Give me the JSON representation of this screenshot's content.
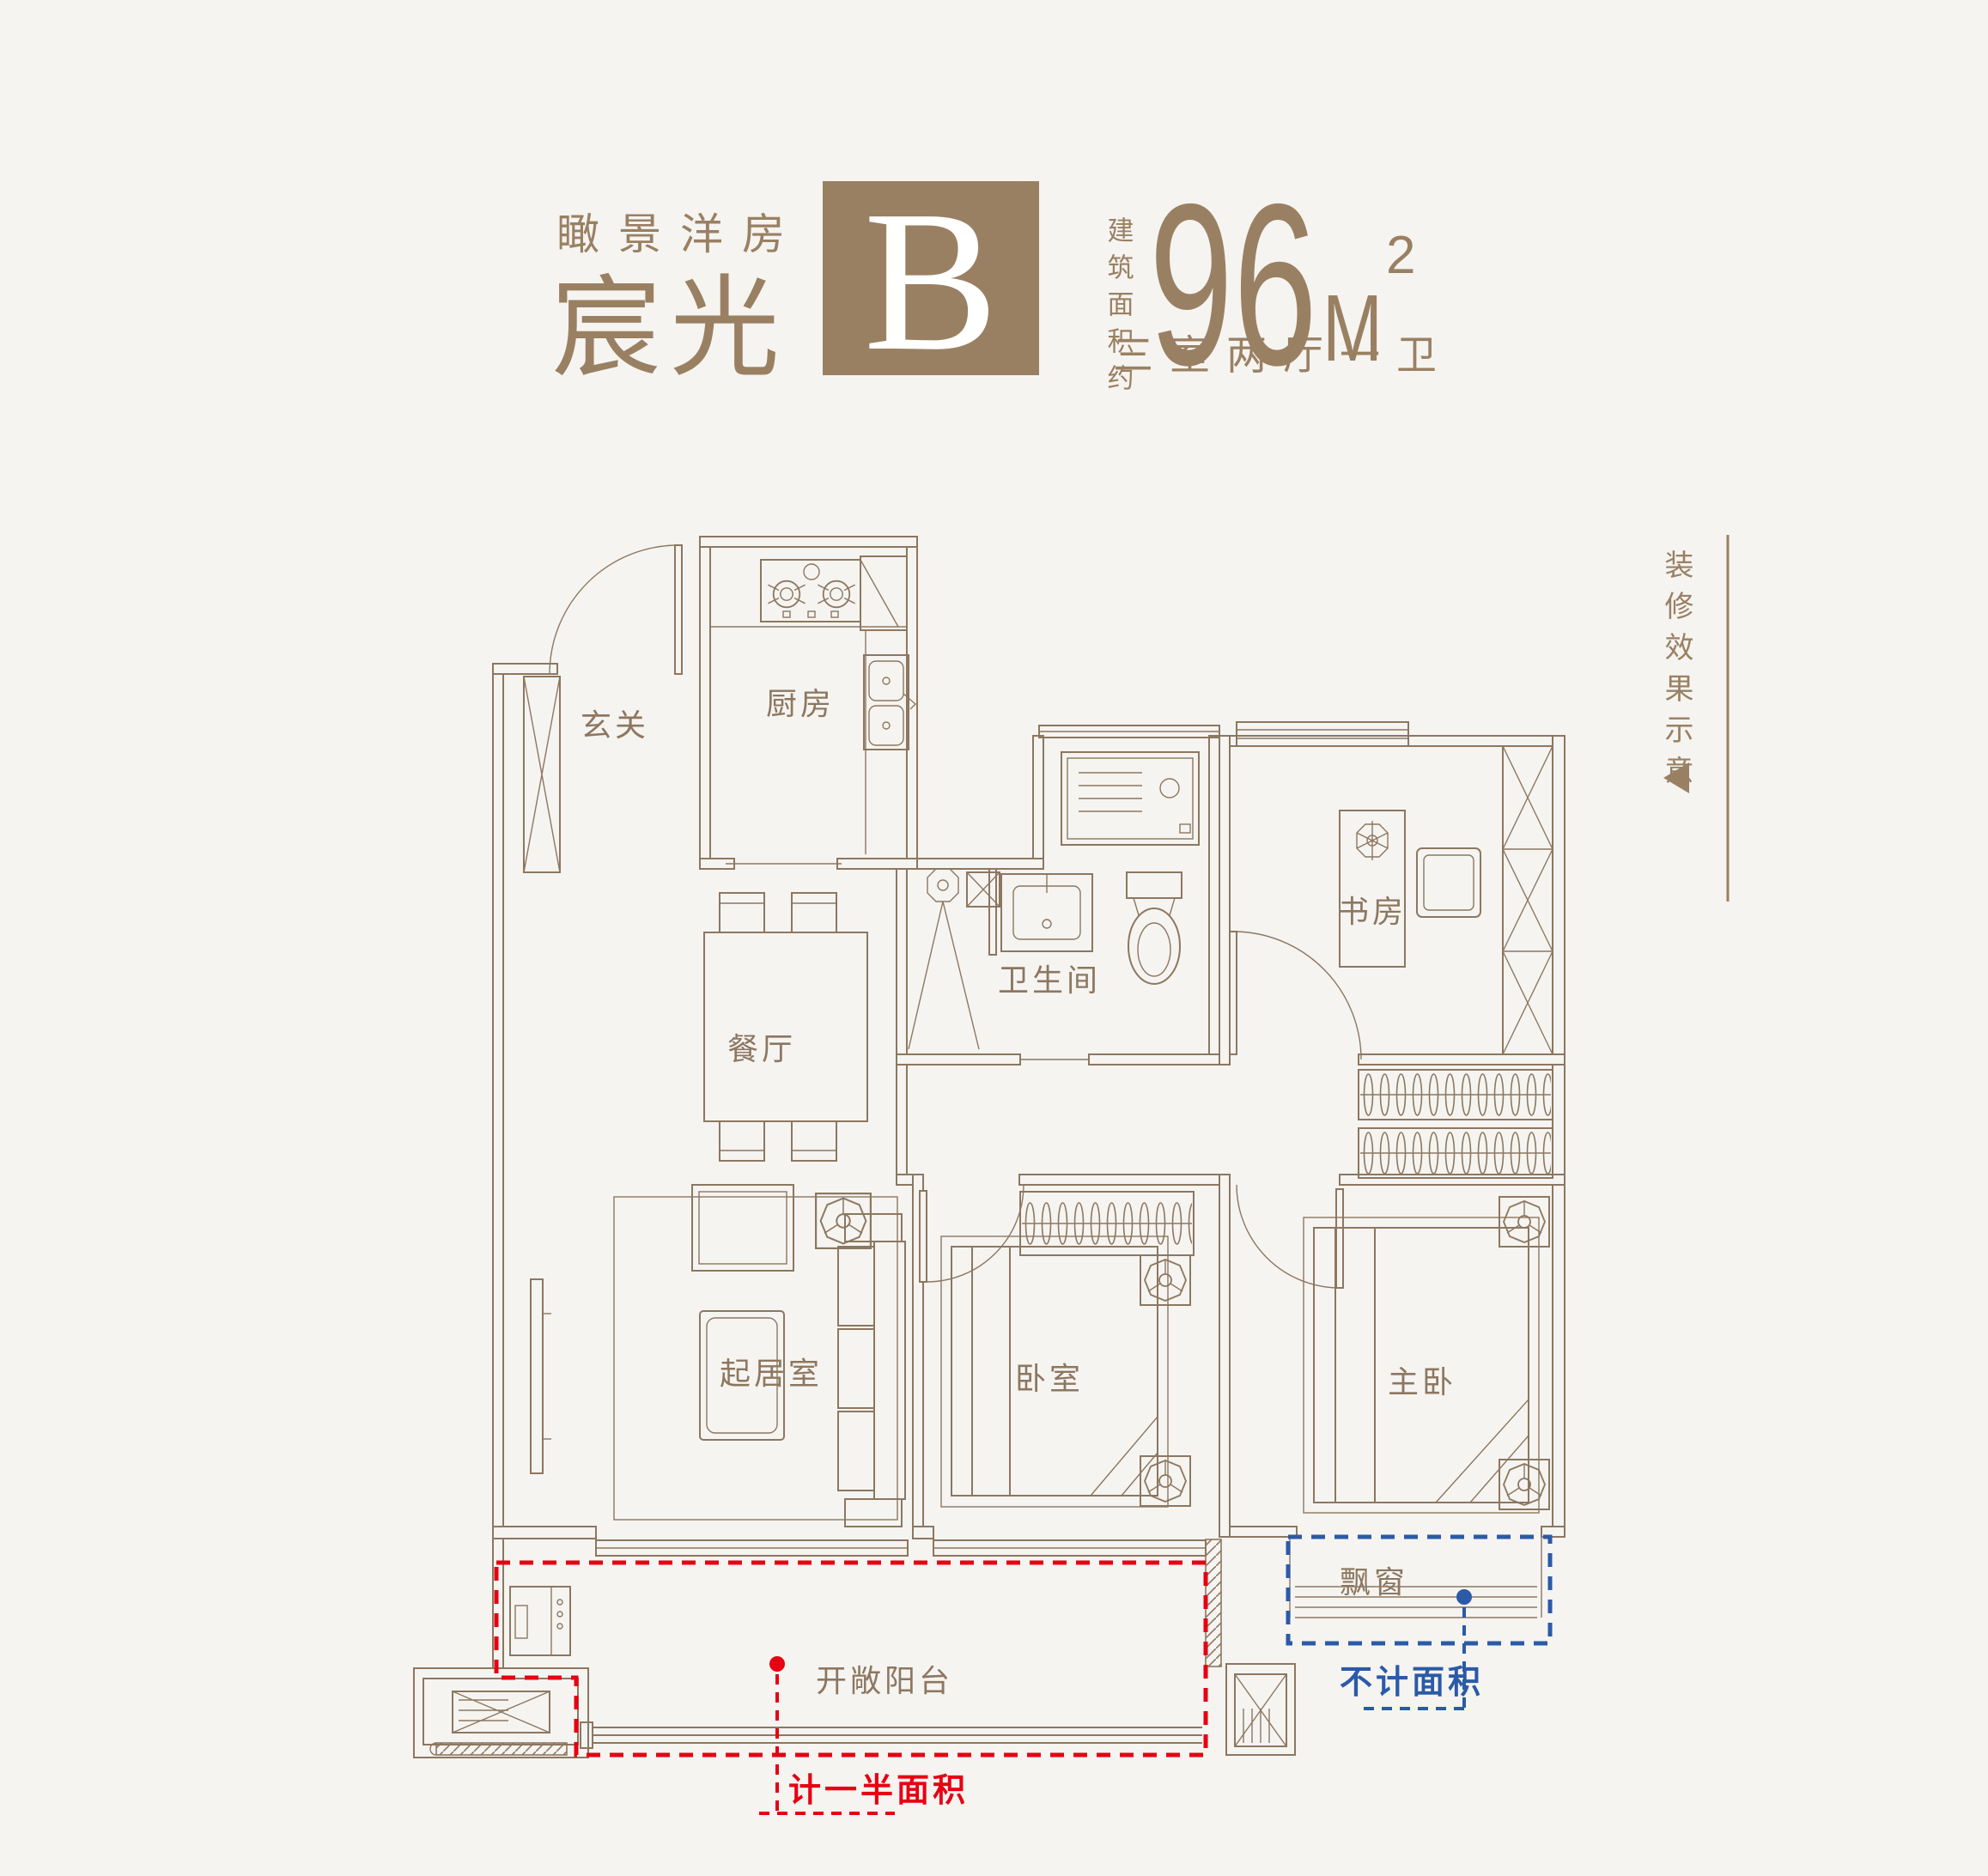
{
  "title": {
    "series_label": "瞰景洋房",
    "name": "宸光",
    "unit_letter": "B",
    "area_prefix": "建筑面积约",
    "area_value": "96",
    "area_unit": "M",
    "area_sup": "2",
    "layout_desc": "三室两厅一卫"
  },
  "side_note": {
    "text": "装修效果示意",
    "arrow_icon": "left-triangle"
  },
  "floor_plan": {
    "rooms": [
      "玄关",
      "厨房",
      "餐厅",
      "卫生间",
      "书房",
      "起居室",
      "卧室",
      "主卧",
      "飘窗",
      "开敞阳台"
    ],
    "annotations": {
      "half_area": "计一半面积",
      "excluded": "不计面积"
    }
  },
  "colors": {
    "background": "#f5f4f1",
    "plan_line_brown": "#8d7760",
    "title_brown": "#9a8062",
    "annotation_red": "#e60012",
    "annotation_blue": "#2b5aa7",
    "unit_box_fill": "#9a8062",
    "unit_letter_color": "#ffffff"
  }
}
